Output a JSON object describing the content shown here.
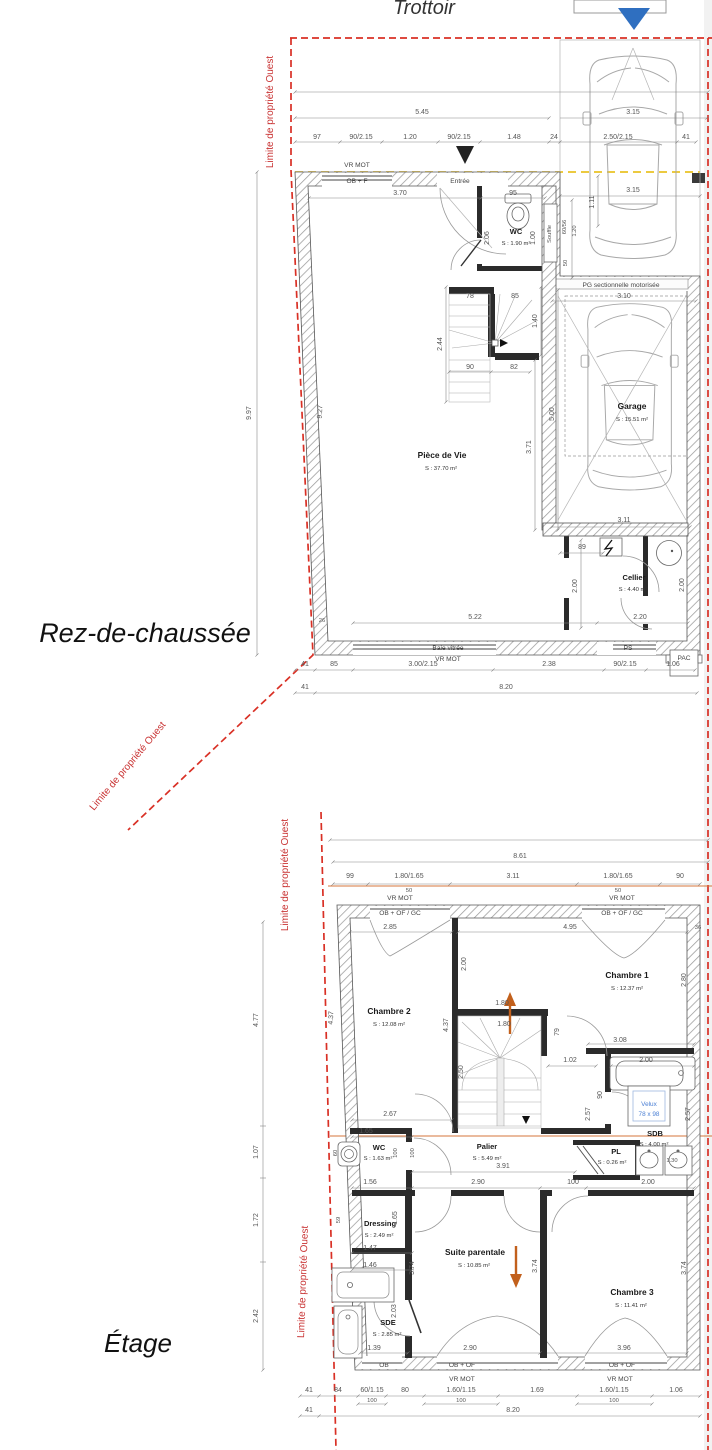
{
  "page": {
    "trottoir": "Trottoir",
    "limite": "Limite de propriété Ouest"
  },
  "rdc": {
    "title": "Rez-de-chaussée",
    "labels": {
      "vr_mot": "VR MOT",
      "ob_f": "OB + F",
      "entree": "Entrée",
      "wc": "WC",
      "wc_area": "S : 1.90 m²",
      "souffle": "Souffle",
      "pg_door": "PG sectionnelle motorisée",
      "garage": "Garage",
      "garage_area": "S : 15.51 m²",
      "piece_de_vie": "Pièce de Vie",
      "piece_de_vie_area": "S : 37.70 m²",
      "cellier": "Cellier",
      "cellier_area": "S : 4.40 m²",
      "baie_vitree": "Baie vitrée",
      "ps": "PS",
      "pac": "PAC"
    },
    "dims": {
      "total_top": "5.45",
      "car_width": "3.15",
      "chain_top": [
        "97",
        "90/2.15",
        "1.20",
        "90/2.15",
        "1.48",
        "24",
        "2.50/2.15",
        "41"
      ],
      "left_total": "9.97",
      "left_inner": "9.27",
      "d370": "3.70",
      "d95": "95",
      "d206": "2.06",
      "d100": "1.00",
      "d111": "1.11",
      "d6056": "60/56",
      "d120": "1.20",
      "d50": "50",
      "d315": "3.15",
      "d310": "3.10",
      "d78": "78",
      "d85": "85",
      "d244": "2.44",
      "d90": "90",
      "d82": "82",
      "d140": "1.40",
      "d500": "5.00",
      "d371": "3.71",
      "d311": "3.11",
      "d89": "89",
      "d200": "2.00",
      "d522": "5.22",
      "d220": "2.20",
      "d26": "26",
      "chain_bottom": [
        "41",
        "85",
        "3.00/2.15",
        "2.38",
        "90/2.15",
        "1.06"
      ],
      "chain_bottom2": [
        "41",
        "8.20"
      ]
    }
  },
  "etage": {
    "title": "Étage",
    "labels": {
      "vr_mot": "VR MOT",
      "ob_of_gc": "OB + OF / GC",
      "ob": "OB",
      "ob_of": "OB + OF",
      "chambre1": "Chambre 1",
      "chambre1_area": "S : 12.37 m²",
      "chambre2": "Chambre 2",
      "chambre2_area": "S : 12.08 m²",
      "chambre3": "Chambre 3",
      "chambre3_area": "S : 11.41 m²",
      "suite": "Suite parentale",
      "suite_area": "S : 10.85 m²",
      "dressing": "Dressing",
      "dressing_area": "S : 2.49 m²",
      "sde": "SDE",
      "sde_area": "S : 2.85 m²",
      "sdb": "SDB",
      "sdb_area": "S : 4.00 m²",
      "wc": "WC",
      "wc_area": "S : 1.63 m²",
      "palier": "Palier",
      "palier_area": "S : 5.49 m²",
      "pl": "PL",
      "pl_area": "S : 0.26 m²",
      "velux": "Velux",
      "velux_size": "78 x 98"
    },
    "dims": {
      "total_top": "8.61",
      "chain_top": [
        "99",
        "1.80/1.65",
        "3.11",
        "1.80/1.65",
        "90"
      ],
      "d50": "50",
      "d285": "2.85",
      "d495": "4.95",
      "d36": "36",
      "d200": "2.00",
      "d437": "4.37",
      "d280": "2.80",
      "d180": "1.80",
      "d79": "79",
      "d308": "3.08",
      "d102": "1.02",
      "d90": "90",
      "d250": "2.50",
      "d257": "2.57",
      "d267": "2.67",
      "d165": "1.65",
      "d100": "100",
      "d60": "60",
      "d391": "3.91",
      "d156": "1.56",
      "d290": "2.90",
      "d130": "1.30",
      "d59": "59",
      "d147": "1.47",
      "d146": "1.46",
      "d374": "3.74",
      "d203": "2.03",
      "d139": "1.39",
      "d396": "3.96",
      "left": [
        "4.77",
        "1.07",
        "1.72",
        "2.42"
      ],
      "chain_bottom": [
        "41",
        "84",
        "60/1.15",
        "80",
        "1.60/1.15",
        "1.69",
        "1.60/1.15",
        "1.06"
      ],
      "chain_bottom2": [
        "41",
        "8.20"
      ]
    }
  }
}
